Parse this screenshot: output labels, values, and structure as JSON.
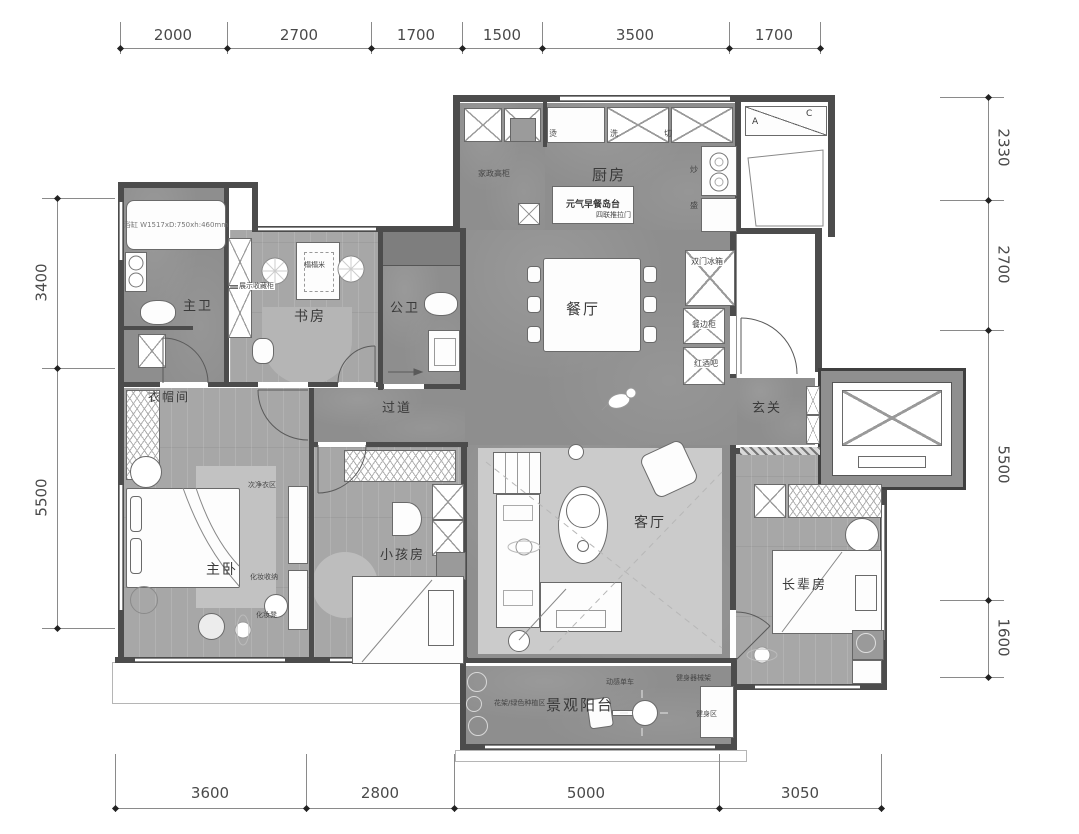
{
  "colors": {
    "wall": "#4c4c4c",
    "marble_floor": "#8e8e8e",
    "wood_floor": "#a7a7a7",
    "living_rug": "#cbcbcb",
    "dim_text": "#4a4a4a"
  },
  "dims": {
    "top": [
      "2000",
      "2700",
      "1700",
      "1500",
      "3500",
      "1700"
    ],
    "bottom": [
      "3600",
      "2800",
      "5000",
      "3050"
    ],
    "left": [
      "3400",
      "5500"
    ],
    "right": [
      "2330",
      "2700",
      "5500",
      "1600"
    ]
  },
  "rooms": {
    "kitchen": "厨房",
    "dining": "餐厅",
    "master_bath": "主卫",
    "public_bath": "公卫",
    "study": "书房",
    "hallway": "过道",
    "foyer": "玄关",
    "cloakroom": "衣帽间",
    "master_bedroom": "主卧",
    "kids_room": "小孩房",
    "living_room": "客厅",
    "elder_room": "长辈房",
    "balcony": "景观阳台"
  },
  "annotations": {
    "island": "元气早餐岛台",
    "sliding_door": "四联推拉门",
    "housekeeping_cabinet": "家政高柜",
    "station_iron": "烫",
    "station_wash": "洗",
    "station_cut": "切",
    "station_fry": "炒",
    "station_serve": "盛",
    "fridge": "双门冰箱",
    "sideboard": "餐边柜",
    "wine_bar": "红酒吧",
    "bathtub_spec": "浴缸 W1517xD:750xh:460mm",
    "display_cabinet": "展示收藏柜",
    "tatami": "榻榻米",
    "clothes_zone": "次净衣区",
    "makeup_storage": "化妆收纳",
    "makeup_stool": "化妆凳",
    "planting": "花架/绿色种植区",
    "spin_bike": "动感单车",
    "fitness_zone": "健身区",
    "fitness_rack": "健身器械架",
    "ac_a": "A",
    "ac_c": "C"
  }
}
